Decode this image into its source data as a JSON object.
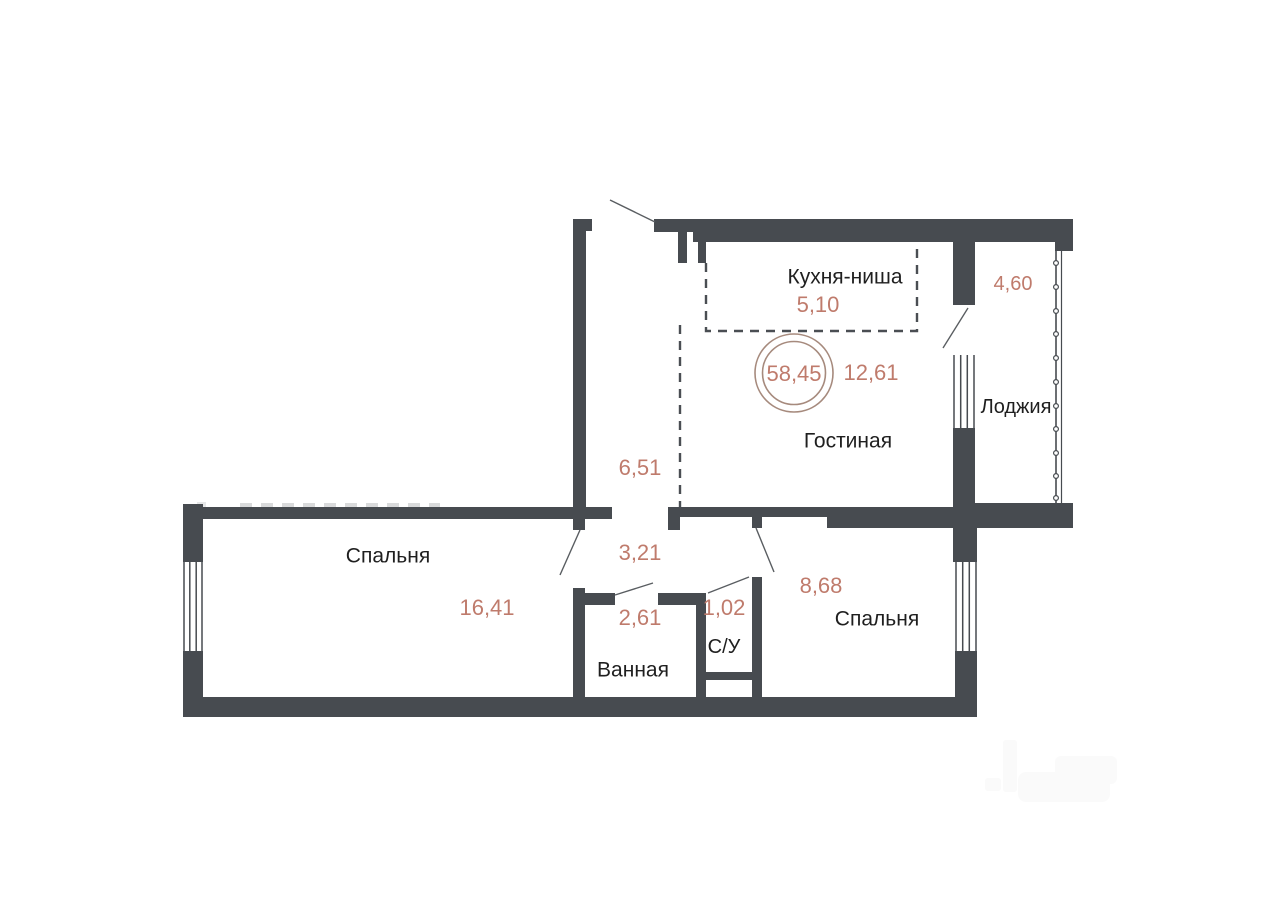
{
  "floor_plan": {
    "total_area_badge": "58,45",
    "rooms": [
      {
        "label": "Кухня-ниша",
        "area": "5,10"
      },
      {
        "label": "Гостиная",
        "area": "12,61"
      },
      {
        "label": "Лоджия",
        "area": "4,60"
      },
      {
        "area": "6,51"
      },
      {
        "area": "3,21"
      },
      {
        "label": "Спальня",
        "area": "16,41"
      },
      {
        "label": "Ванная",
        "area": "2,61"
      },
      {
        "label": "С/У",
        "area": "1,02"
      },
      {
        "label": "Спальня",
        "area": "8,68"
      }
    ],
    "colors": {
      "wall": "#474b50",
      "area_text": "#bf7b6c",
      "room_text": "#1f1f1f",
      "badge_ring": "#a68a7d",
      "background": "#ffffff"
    }
  }
}
